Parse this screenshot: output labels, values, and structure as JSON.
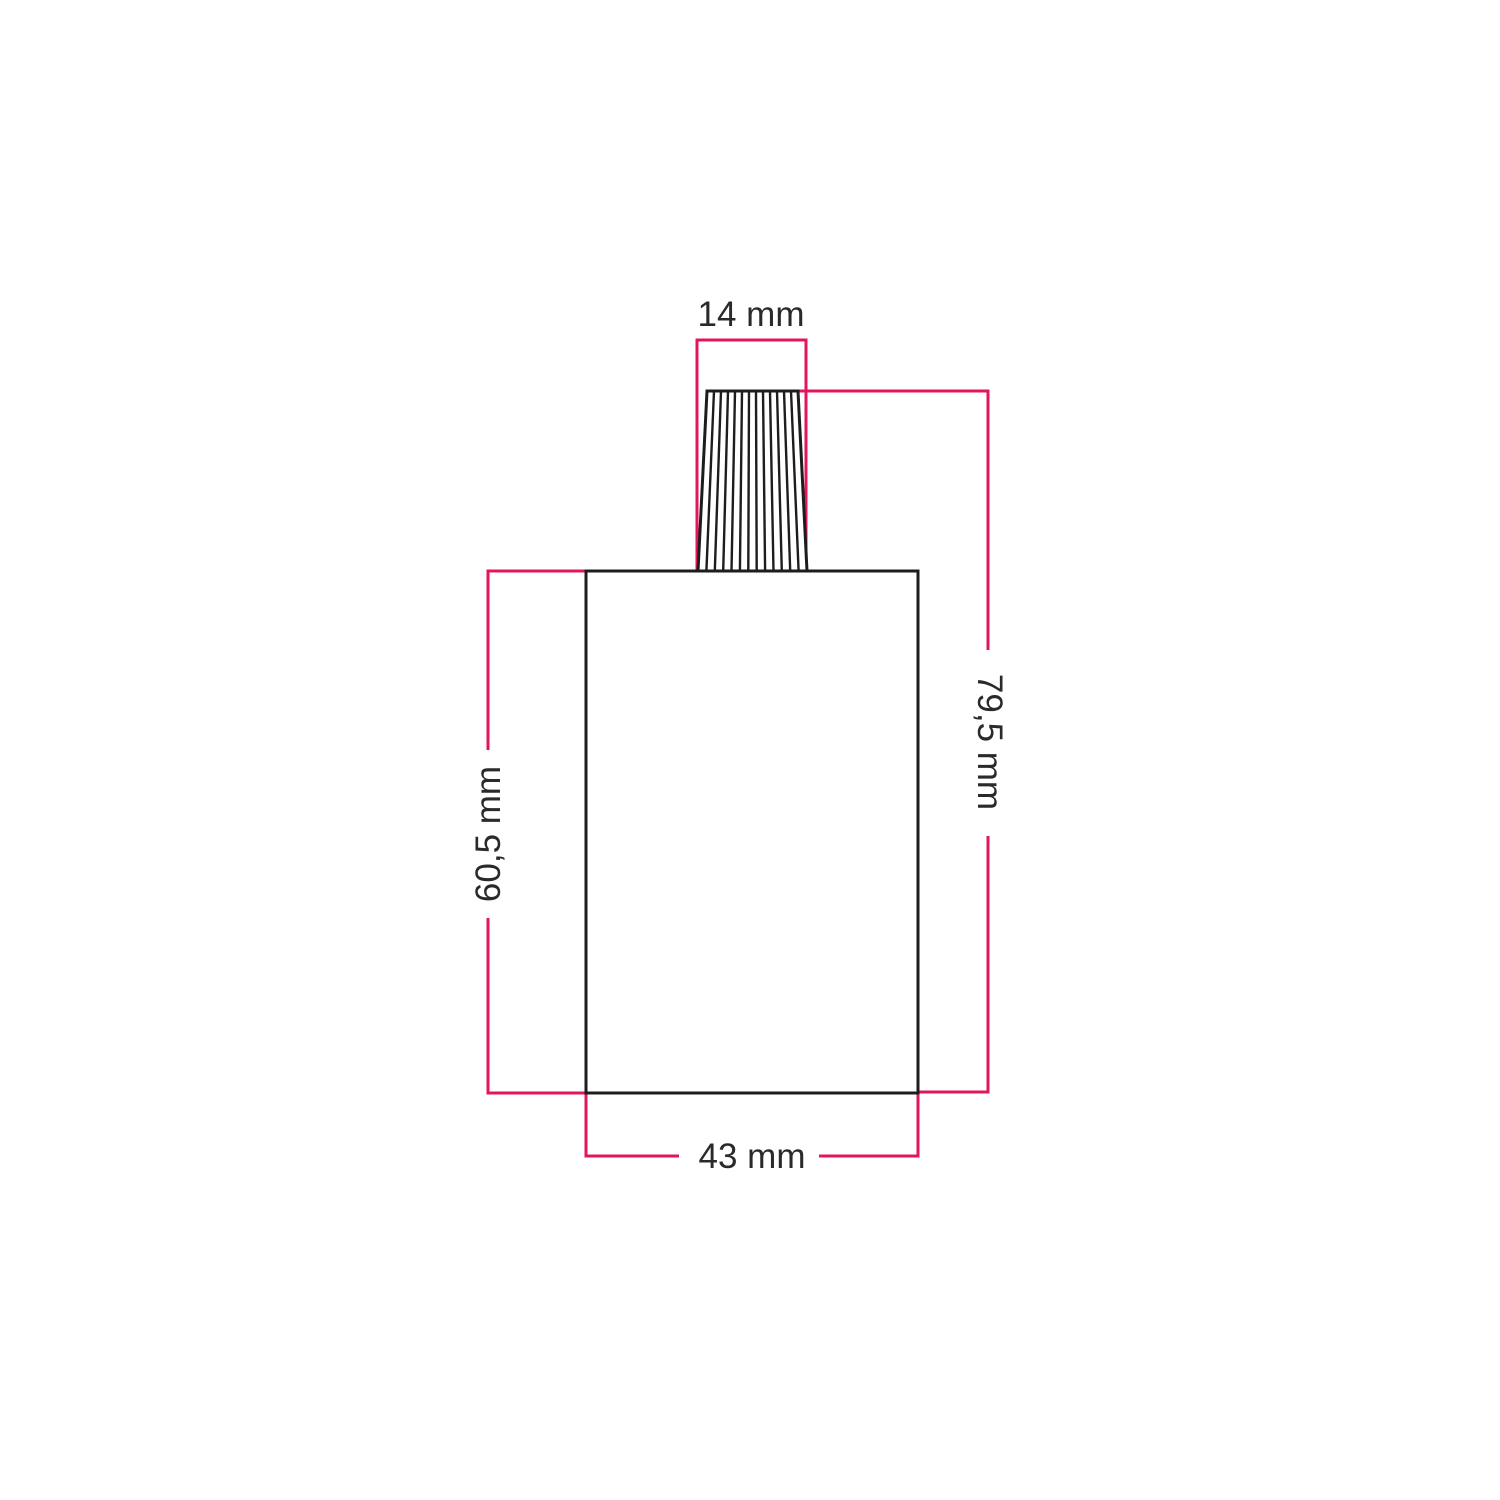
{
  "canvas": {
    "background": "#ffffff"
  },
  "colors": {
    "dimension_line": "#e2155e",
    "outline": "#1d1d1b",
    "label_text": "#2b2a29"
  },
  "labels": {
    "top_width": "14 mm",
    "total_height": "79,5 mm",
    "body_height": "60,5 mm",
    "body_width": "43 mm"
  }
}
